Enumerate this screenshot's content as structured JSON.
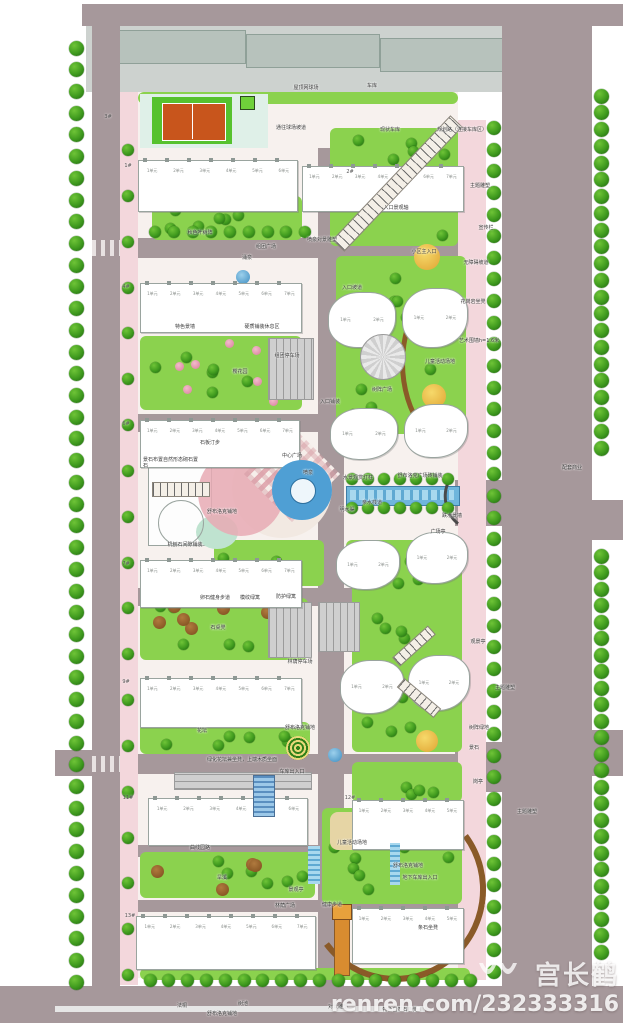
{
  "watermark": {
    "name": "宫长鹤",
    "url": "renren.com/232333316"
  },
  "unit_suffix": "单元",
  "site": {
    "colors": {
      "road": "#a6989b",
      "yard": "#cdd2cf",
      "yard_bldg": "#b7c2bc",
      "base": "#f7f1ee",
      "pink": "#f3d7dc",
      "lawn": "#8bd24e",
      "water": "#4f9fd4",
      "canal": "#6fb6dc",
      "court": "#c8551c",
      "pad": "#56c22e",
      "apron": "#dff0e8",
      "tan": "#e6d5a5",
      "brown": "#8a5a28"
    },
    "roads": [
      {
        "name": "top-road",
        "rect": [
          82,
          4,
          541,
          22
        ]
      },
      {
        "name": "left-road",
        "rect": [
          92,
          24,
          28,
          975
        ]
      },
      {
        "name": "right-road",
        "rect": [
          502,
          20,
          90,
          1003
        ]
      },
      {
        "name": "bottom-road",
        "rect": [
          0,
          986,
          623,
          37
        ]
      },
      {
        "name": "center-road",
        "rect": [
          318,
          148,
          26,
          840
        ]
      },
      {
        "name": "ew-road-1",
        "rect": [
          120,
          238,
          350,
          20
        ]
      },
      {
        "name": "ew-road-2",
        "rect": [
          120,
          414,
          350,
          18
        ]
      },
      {
        "name": "ew-road-3",
        "rect": [
          120,
          588,
          350,
          18
        ]
      },
      {
        "name": "ew-road-4",
        "rect": [
          92,
          754,
          380,
          20
        ]
      },
      {
        "name": "ew-road-5",
        "rect": [
          130,
          845,
          340,
          12
        ]
      },
      {
        "name": "ew-road-6",
        "rect": [
          130,
          900,
          340,
          12
        ]
      },
      {
        "name": "right-flare-1",
        "rect": [
          455,
          480,
          60,
          46
        ]
      },
      {
        "name": "right-flare-2",
        "rect": [
          455,
          742,
          60,
          50
        ]
      },
      {
        "name": "east-flare-1",
        "rect": [
          592,
          500,
          31,
          40
        ]
      },
      {
        "name": "east-flare-2",
        "rect": [
          592,
          730,
          31,
          46
        ]
      },
      {
        "name": "west-arm",
        "rect": [
          55,
          750,
          40,
          26
        ]
      }
    ],
    "sidewalks": [
      {
        "name": "left-sidewalk",
        "rect": [
          120,
          92,
          18,
          893
        ]
      },
      {
        "name": "right-sidewalk",
        "rect": [
          458,
          120,
          28,
          860
        ]
      }
    ],
    "yard": {
      "rect": [
        86,
        26,
        478,
        66
      ],
      "buildings": [
        [
          112,
          30,
          132,
          32
        ],
        [
          246,
          34,
          132,
          32
        ],
        [
          380,
          38,
          130,
          32
        ],
        [
          514,
          44,
          50,
          28
        ]
      ]
    },
    "base_rect": [
      138,
      92,
      320,
      886
    ],
    "lawns": [
      {
        "rect": [
          138,
          92,
          320,
          12
        ],
        "trees": 0
      },
      {
        "rect": [
          152,
          196,
          150,
          44
        ],
        "trees": 6
      },
      {
        "rect": [
          330,
          128,
          128,
          118
        ],
        "trees": 10
      },
      {
        "rect": [
          336,
          256,
          130,
          178
        ],
        "trees": 12
      },
      {
        "rect": [
          140,
          336,
          162,
          74
        ],
        "trees": 7,
        "flowers": 8
      },
      {
        "rect": [
          214,
          540,
          110,
          46
        ],
        "trees": 6
      },
      {
        "rect": [
          346,
          540,
          112,
          44
        ],
        "trees": 5
      },
      {
        "rect": [
          140,
          598,
          168,
          62
        ],
        "trees": 6,
        "browns": 6
      },
      {
        "rect": [
          352,
          556,
          110,
          196
        ],
        "trees": 14
      },
      {
        "rect": [
          140,
          722,
          170,
          32
        ],
        "trees": 6
      },
      {
        "rect": [
          352,
          762,
          110,
          40
        ],
        "trees": 4
      },
      {
        "rect": [
          140,
          852,
          175,
          46
        ],
        "trees": 6,
        "browns": 4
      },
      {
        "rect": [
          322,
          808,
          140,
          96
        ],
        "trees": 8
      },
      {
        "rect": [
          140,
          968,
          330,
          12
        ],
        "trees": 0
      }
    ],
    "tree_rows": [
      {
        "a": [
          76,
          48
        ],
        "b": [
          76,
          982
        ],
        "n": 44,
        "s": 15
      },
      {
        "a": [
          128,
          150
        ],
        "b": [
          128,
          975
        ],
        "n": 19,
        "s": 12
      },
      {
        "a": [
          494,
          128
        ],
        "b": [
          494,
          972
        ],
        "n": 40,
        "s": 14
      },
      {
        "a": [
          601,
          96
        ],
        "b": [
          601,
          448
        ],
        "n": 22,
        "s": 15
      },
      {
        "a": [
          601,
          556
        ],
        "b": [
          601,
          952
        ],
        "n": 25,
        "s": 15
      },
      {
        "a": [
          150,
          980
        ],
        "b": [
          470,
          980
        ],
        "n": 18,
        "s": 13
      },
      {
        "a": [
          352,
          479
        ],
        "b": [
          448,
          479
        ],
        "n": 7,
        "s": 12
      },
      {
        "a": [
          352,
          508
        ],
        "b": [
          448,
          508
        ],
        "n": 7,
        "s": 12
      },
      {
        "a": [
          155,
          232
        ],
        "b": [
          305,
          232
        ],
        "n": 9,
        "s": 12
      }
    ],
    "buildings": [
      {
        "rect": [
          138,
          160,
          160,
          52
        ],
        "units": 6
      },
      {
        "rect": [
          302,
          166,
          162,
          46
        ],
        "units": 7
      },
      {
        "rect": [
          140,
          283,
          162,
          50
        ],
        "units": 7
      },
      {
        "rect": [
          140,
          420,
          160,
          48
        ],
        "units": 7
      },
      {
        "rect": [
          140,
          560,
          162,
          48
        ],
        "units": 7
      },
      {
        "rect": [
          140,
          678,
          162,
          50
        ],
        "units": 7
      },
      {
        "rect": [
          148,
          798,
          160,
          48
        ],
        "units": 6
      },
      {
        "rect": [
          352,
          800,
          112,
          50
        ],
        "units": 5
      },
      {
        "rect": [
          136,
          916,
          180,
          54
        ],
        "units": 7
      },
      {
        "rect": [
          352,
          908,
          112,
          56
        ],
        "units": 5
      }
    ],
    "towers": [
      {
        "rect": [
          328,
          292,
          66,
          54
        ]
      },
      {
        "rect": [
          402,
          288,
          64,
          58
        ]
      },
      {
        "rect": [
          330,
          408,
          66,
          50
        ]
      },
      {
        "rect": [
          404,
          404,
          62,
          52
        ]
      },
      {
        "rect": [
          336,
          540,
          62,
          48
        ]
      },
      {
        "rect": [
          406,
          532,
          60,
          50
        ]
      },
      {
        "rect": [
          340,
          660,
          62,
          52
        ]
      },
      {
        "rect": [
          408,
          655,
          60,
          54
        ]
      }
    ],
    "parkings": [
      {
        "rect": [
          268,
          338,
          44,
          60
        ],
        "dir": "h"
      },
      {
        "rect": [
          268,
          602,
          42,
          54
        ],
        "dir": "h"
      },
      {
        "rect": [
          318,
          602,
          40,
          48
        ],
        "dir": "h"
      },
      {
        "rect": [
          174,
          772,
          136,
          16
        ],
        "dir": "v"
      }
    ],
    "playgrounds": [
      [
        414,
        244,
        26
      ],
      [
        422,
        384,
        24
      ],
      [
        416,
        730,
        22
      ]
    ],
    "ponds": [
      [
        236,
        270,
        14
      ],
      [
        328,
        748,
        14
      ]
    ],
    "building_numbers": [
      [
        "3#",
        108,
        117
      ],
      [
        "1#",
        128,
        166
      ],
      [
        "2#",
        350,
        172
      ],
      [
        "4#",
        126,
        287
      ],
      [
        "6#",
        126,
        424
      ],
      [
        "7#",
        126,
        564
      ],
      [
        "9#",
        126,
        682
      ],
      [
        "11#",
        128,
        798
      ],
      [
        "12#",
        350,
        798
      ],
      [
        "13#",
        130,
        916
      ]
    ],
    "labels": [
      [
        "屋顶网球场",
        306,
        88
      ],
      [
        "车库",
        372,
        86
      ],
      [
        "现状车库",
        390,
        130
      ],
      [
        "规划路（连接车库区）",
        462,
        130
      ],
      [
        "通往球场坡道",
        291,
        128
      ],
      [
        "主题雕塑",
        480,
        186
      ],
      [
        "宣传栏",
        486,
        228
      ],
      [
        "无障碍坡道",
        476,
        263
      ],
      [
        "花岗岩坐凳",
        473,
        302
      ],
      [
        "艺术围墙h=1.6米",
        479,
        341
      ],
      [
        "秋色叶树阵",
        200,
        233
      ],
      [
        "组团广场",
        266,
        247
      ],
      [
        "喷泉对景雕塑",
        322,
        240
      ],
      [
        "涌泉",
        247,
        258
      ],
      [
        "入口景观轴",
        396,
        208
      ],
      [
        "小区主入口",
        424,
        252
      ],
      [
        "硬质铺装休息区",
        262,
        327
      ],
      [
        "特色景墙",
        185,
        327
      ],
      [
        "组团停车场",
        287,
        356
      ],
      [
        "樱花园",
        240,
        372
      ],
      [
        "入口坡道",
        352,
        288
      ],
      [
        "入口铺装",
        330,
        402
      ],
      [
        "树阵广场",
        382,
        390
      ],
      [
        "儿童活动场地",
        440,
        362
      ],
      [
        "石板汀步",
        210,
        443
      ],
      [
        "中心广场",
        292,
        456
      ],
      [
        "喷泉",
        308,
        473
      ],
      [
        "水景观赏灯柱",
        358,
        478
      ],
      [
        "亲水栈道",
        372,
        503
      ],
      [
        "舒布洛克广场砖铺装",
        420,
        476
      ],
      [
        "明水渠",
        347,
        510
      ],
      [
        "跌水景墙",
        452,
        516
      ],
      [
        "广场亭",
        438,
        532
      ],
      [
        "舒布洛克铺地",
        222,
        512
      ],
      [
        "机刨石间隙铺装",
        185,
        545
      ],
      [
        "配套商业",
        572,
        468
      ],
      [
        "卵石健身步道",
        215,
        598
      ],
      [
        "模纹绿篱",
        250,
        598
      ],
      [
        "防护绿篱",
        286,
        597
      ],
      [
        "石桌凳",
        218,
        628
      ],
      [
        "林荫停车场",
        300,
        662
      ],
      [
        "花坛",
        202,
        731
      ],
      [
        "舒布洛克铺地",
        300,
        728
      ],
      [
        "绿化花坛兼坐凳，上端木质坐面",
        242,
        760
      ],
      [
        "车库出入口",
        292,
        772
      ],
      [
        "观景亭",
        478,
        642
      ],
      [
        "主题雕塑",
        505,
        688
      ],
      [
        "树阵绿地",
        479,
        728
      ],
      [
        "景石",
        474,
        748
      ],
      [
        "岗亭",
        478,
        782
      ],
      [
        "主题雕塑",
        527,
        812
      ],
      [
        "曲线园路",
        200,
        848
      ],
      [
        "旱溪",
        222,
        878
      ],
      [
        "儿童活动场地",
        352,
        843
      ],
      [
        "舒布洛克铺地",
        408,
        866
      ],
      [
        "地下车库出入口",
        420,
        878
      ],
      [
        "景观亭",
        296,
        890
      ],
      [
        "林荫广场",
        285,
        906
      ],
      [
        "健康步道",
        332,
        905
      ],
      [
        "条石坐凳",
        428,
        928
      ],
      [
        "法桐",
        182,
        1006
      ],
      [
        "树池",
        243,
        1004
      ],
      [
        "舒布洛克铺地",
        222,
        1014
      ],
      [
        "对景雕塑",
        338,
        1007
      ],
      [
        "特色自然石条凳",
        400,
        1010
      ]
    ],
    "two_line_label": {
      "text": "景石布置自然形态砌石置石",
      "x": 172,
      "y": 463
    }
  }
}
